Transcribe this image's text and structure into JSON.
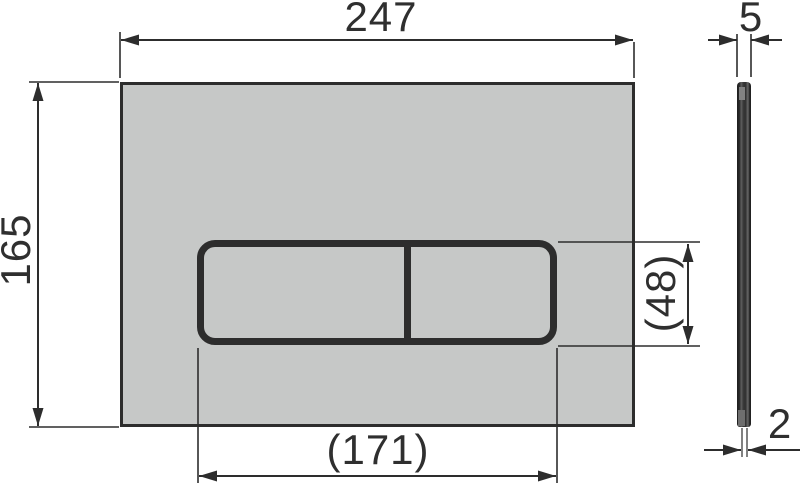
{
  "labels": {
    "plate_width": "247",
    "plate_height": "165",
    "plate_thickness": "5",
    "edge_thickness": "2",
    "button_area_width": "(171)",
    "button_area_height": "(48)"
  },
  "colors": {
    "plate_fill": "#c6c8c7",
    "outline": "#2d2d2d",
    "dimension_text": "#2f2f2f",
    "background": "#ffffff"
  }
}
